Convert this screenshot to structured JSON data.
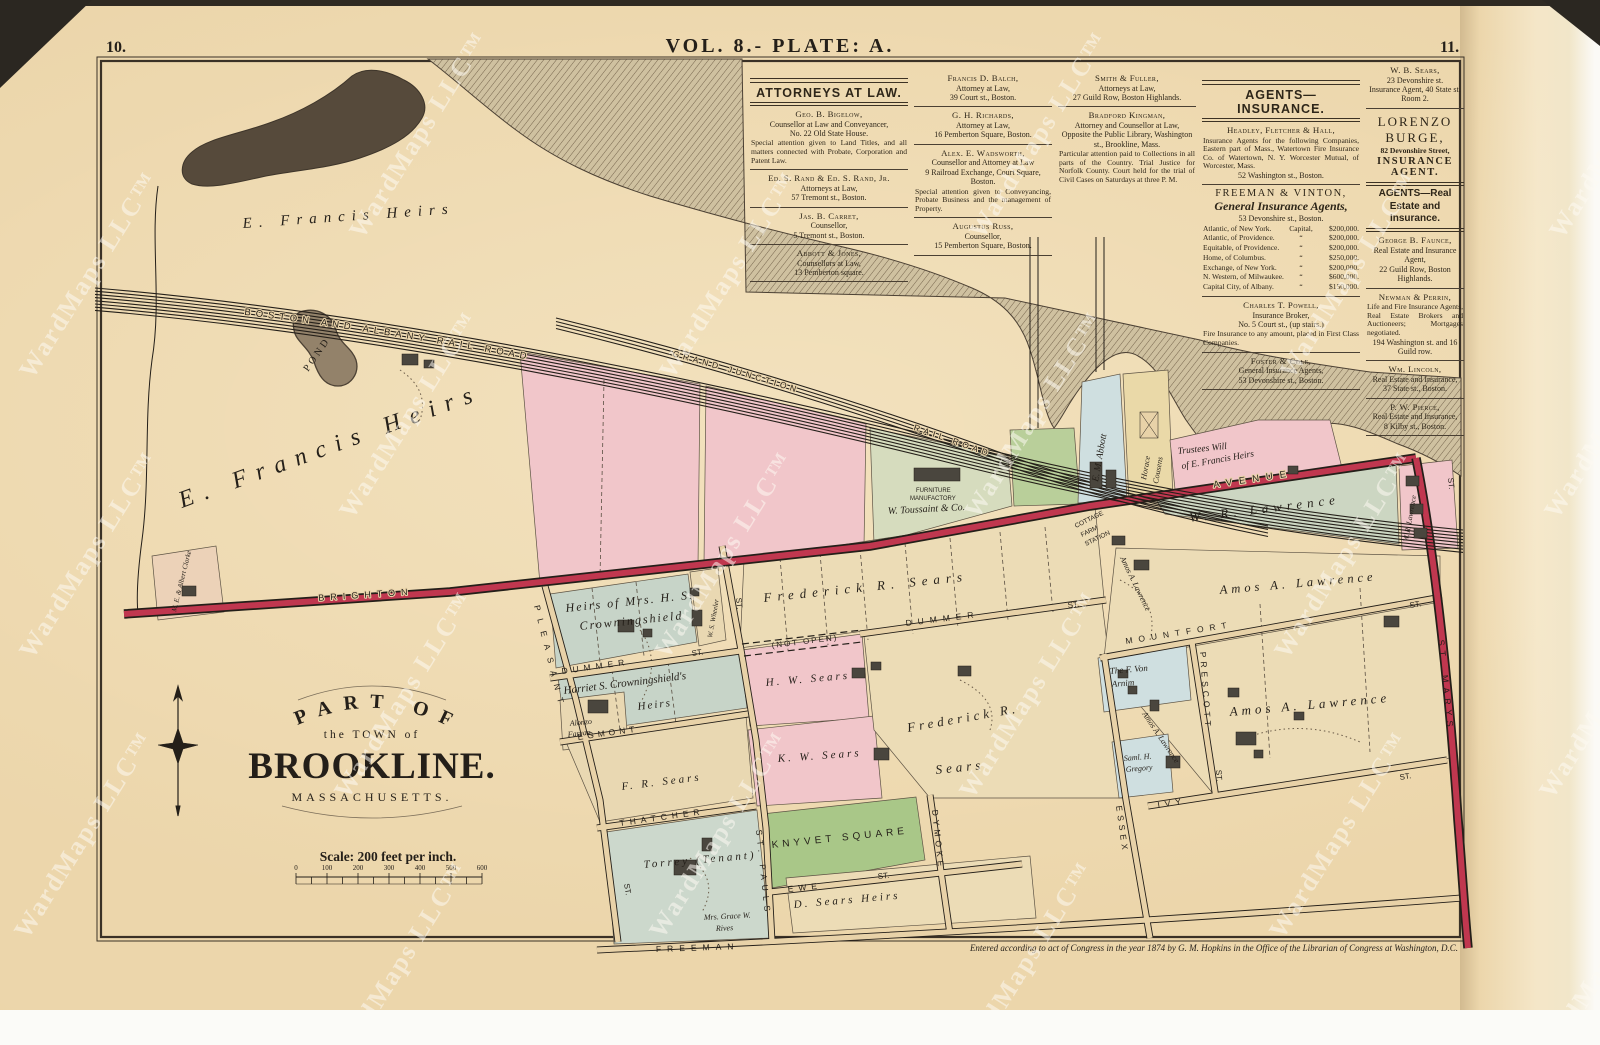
{
  "page": {
    "left_number": "10.",
    "right_number": "11.",
    "plate_title": "VOL. 8.- PLATE: A.",
    "copyright": "Entered according to act of Congress in the year 1874 by G. M. Hopkins in the Office of the Librarian of Congress at Washington, D.C.",
    "watermark": "WardMaps LLC™"
  },
  "title_block": {
    "line1": "PART OF",
    "line2": "the TOWN of",
    "line3": "BROOKLINE.",
    "line4": "MASSACHUSETTS.",
    "scale_text": "Scale: 200 feet per inch.",
    "scale_ticks": [
      "0",
      "100",
      "200",
      "300",
      "400",
      "500",
      "600"
    ]
  },
  "directory": {
    "attorneys": {
      "header": "ATTORNEYS AT LAW.",
      "col1": [
        {
          "name": "Geo. B. Bigelow,",
          "lines": "Counsellor at Law and Conveyancer,\nNo. 22 Old State House.",
          "note": "Special attention given to Land Titles, and all matters connected with Probate, Corporation and Patent Law."
        },
        {
          "name": "Ed. S. Rand & Ed. S. Rand, Jr.",
          "lines": "Attorneys at Law,\n57 Tremont st., Boston."
        },
        {
          "name": "Jas. B. Carret,",
          "lines": "Counsellor,\n5 Tremont st., Boston."
        },
        {
          "name": "Abbott & Jones,",
          "lines": "Counsellors at Law,\n13 Pemberton square."
        }
      ],
      "col2": [
        {
          "name": "Francis D. Balch,",
          "lines": "Attorney at Law,\n39 Court st., Boston."
        },
        {
          "name": "G. H. Richards,",
          "lines": "Attorney at Law,\n16 Pemberton Square, Boston."
        },
        {
          "name": "Alex. E. Wadsworth,",
          "lines": "Counsellor and Attorney at Law\n9 Railroad Exchange, Court Square, Boston.",
          "note": "Special attention given to Conveyancing, Probate Business and the management of Property."
        },
        {
          "name": "Augustus Russ,",
          "lines": "Counsellor,\n15 Pemberton Square, Boston."
        }
      ],
      "col3": [
        {
          "name": "Smith & Fuller,",
          "lines": "Attorneys at Law,\n27 Guild Row, Boston Highlands."
        },
        {
          "name": "Bradford Kingman,",
          "lines": "Attorney and Counsellor at Law,\nOpposite the Public Library, Washington st., Brookline, Mass.",
          "note": "Particular attention paid to Collections in all parts of the Country. Trial Justice for Norfolk County. Court held for the trial of Civil Cases on Saturdays at three P. M."
        }
      ]
    },
    "insurance": {
      "header": "AGENTS—INSURANCE.",
      "headley": {
        "name": "Headley, Fletcher & Hall,",
        "note": "Insurance Agents for the following Companies, Eastern part of Mass., Watertown Fire Insurance Co. of Watertown, N. Y. Worcester Mutual, of Worcester, Mass.",
        "line": "52 Washington st., Boston."
      },
      "freeman": {
        "name": "FREEMAN & VINTON,",
        "subtitle": "General Insurance Agents,",
        "line": "53 Devonshire st., Boston.",
        "companies": [
          [
            "Atlantic, of New York.",
            "Capital,",
            "$200,000."
          ],
          [
            "Atlantic, of Providence.",
            "“",
            "$200,000."
          ],
          [
            "Equitable, of Providence.",
            "“",
            "$200,000."
          ],
          [
            "Home, of Columbus.",
            "“",
            "$250,000."
          ],
          [
            "Exchange, of New York.",
            "“",
            "$200,000."
          ],
          [
            "N. Western, of Milwaukee.",
            "“",
            "$600,000."
          ],
          [
            "Capital City, of Albany.",
            "“",
            "$150,000."
          ]
        ]
      },
      "powell": {
        "name": "Charles T. Powell,",
        "lines": "Insurance Broker,\nNo. 5 Court st., (up stairs.)",
        "note": "Fire Insurance to any amount, placed in First Class Companies."
      },
      "foster": {
        "name": "Foster & Cole,",
        "lines": "General Insurance Agents,\n53 Devonshire st., Boston."
      }
    },
    "col5": {
      "sears": {
        "name": "W. B. Sears,",
        "lines": "23 Devonshire st.\nInsurance Agent, 40 State st. Room 2."
      },
      "burge": {
        "name": "LORENZO BURGE,",
        "line": "82 Devonshire Street,",
        "role": "INSURANCE AGENT."
      },
      "header2": "AGENTS—Real Estate and Insurance.",
      "faunce": {
        "name": "George B. Faunce,",
        "lines": "Real Estate and Insurance Agent,\n22 Guild Row, Boston Highlands."
      },
      "newman": {
        "name": "Newman & Perrin,",
        "note": "Life and Fire Insurance Agents, Real Estate Brokers and Auctioneers; Mortgages negotiated.",
        "line": "194 Washington st. and 16 Guild row."
      },
      "lincoln": {
        "name": "Wm. Lincoln,",
        "lines": "Real Estate and Insurance,\n37 State st., Boston."
      },
      "pierce": {
        "name": "P. W. Pierce,",
        "lines": "Real Estate and Insurance,\n8 Kilby st., Boston."
      }
    }
  },
  "map": {
    "railroads": {
      "boston_albany": "BOSTON  AND  ALBANY  RAIL  ROAD",
      "grand_junction": "GRAND  JUNCTION",
      "rail_road": "RAIL  ROAD"
    },
    "roads": {
      "brighton": "BRIGHTON",
      "avenue": "AVENUE",
      "st_marys": "ST. MARYS",
      "pleasant": "PLEASANT",
      "dummer": "DUMMER",
      "egmont": "EGMONT",
      "thatcher": "THATCHER",
      "freeman": "FREEMAN",
      "ewe": "EWE",
      "st_pauls": "ST. PAULS",
      "dymoke": "DYMOKE",
      "essex": "ESSEX",
      "ivy": "IVY",
      "mountfort": "MOUNTFORT",
      "prescott": "PRESCOTT",
      "st_abbrev": "ST.",
      "not_open": "(NOT OPEN)"
    },
    "station": {
      "l1": "COTTAGE",
      "l2": "FARM",
      "l3": "STATION"
    },
    "features": {
      "pond": "POND"
    },
    "parcels": {
      "e_francis_top": "E. Francis Heirs",
      "e_francis_left": "E. Francis Heirs",
      "crowningshield_l1": "Heirs of Mrs. H. S.",
      "crowningshield_l2": "Crowningshield",
      "harriet_l1": "Harriet S. Crowningshield's",
      "harriet_l2": "Heirs",
      "alonzo_l1": "Alonzo",
      "alonzo_l2": "Farran",
      "wheeler": "W. S. Wheeler",
      "frederick_strip": "Frederick  R.  Sears",
      "frederick_l1": "Frederick  R.",
      "frederick_l2": "Sears",
      "fr_sears": "F. R. Sears",
      "hw_sears": "H. W. Sears",
      "kw_sears": "K. W. Sears",
      "torrey": "Torrey (Tenant)",
      "rives_l1": "Mrs. Grace W.",
      "rives_l2": "Rives",
      "d_sears": "D. Sears Heirs",
      "knyvet": "KNYVET SQUARE",
      "von_arnim_l1": "The F. Von",
      "von_arnim_l2": "Arnim",
      "gregory_l1": "Saml. H.",
      "gregory_l2": "Gregory",
      "amos": "Amos A. Lawrence",
      "wr_lawrence": "W. R. Lawrence",
      "abbott": "E. M. Abbott",
      "cousens_l1": "Horace",
      "cousens_l2": "Cousens",
      "trustees_l1": "Trustees Will",
      "trustees_l2": "of E. Francis Heirs",
      "toussaint_l1": "FURNITURE",
      "toussaint_l2": "MANUFACTORY",
      "toussaint_l3": "W. Toussaint & Co.",
      "clarke": "M. E. & Albert Clarke"
    }
  }
}
